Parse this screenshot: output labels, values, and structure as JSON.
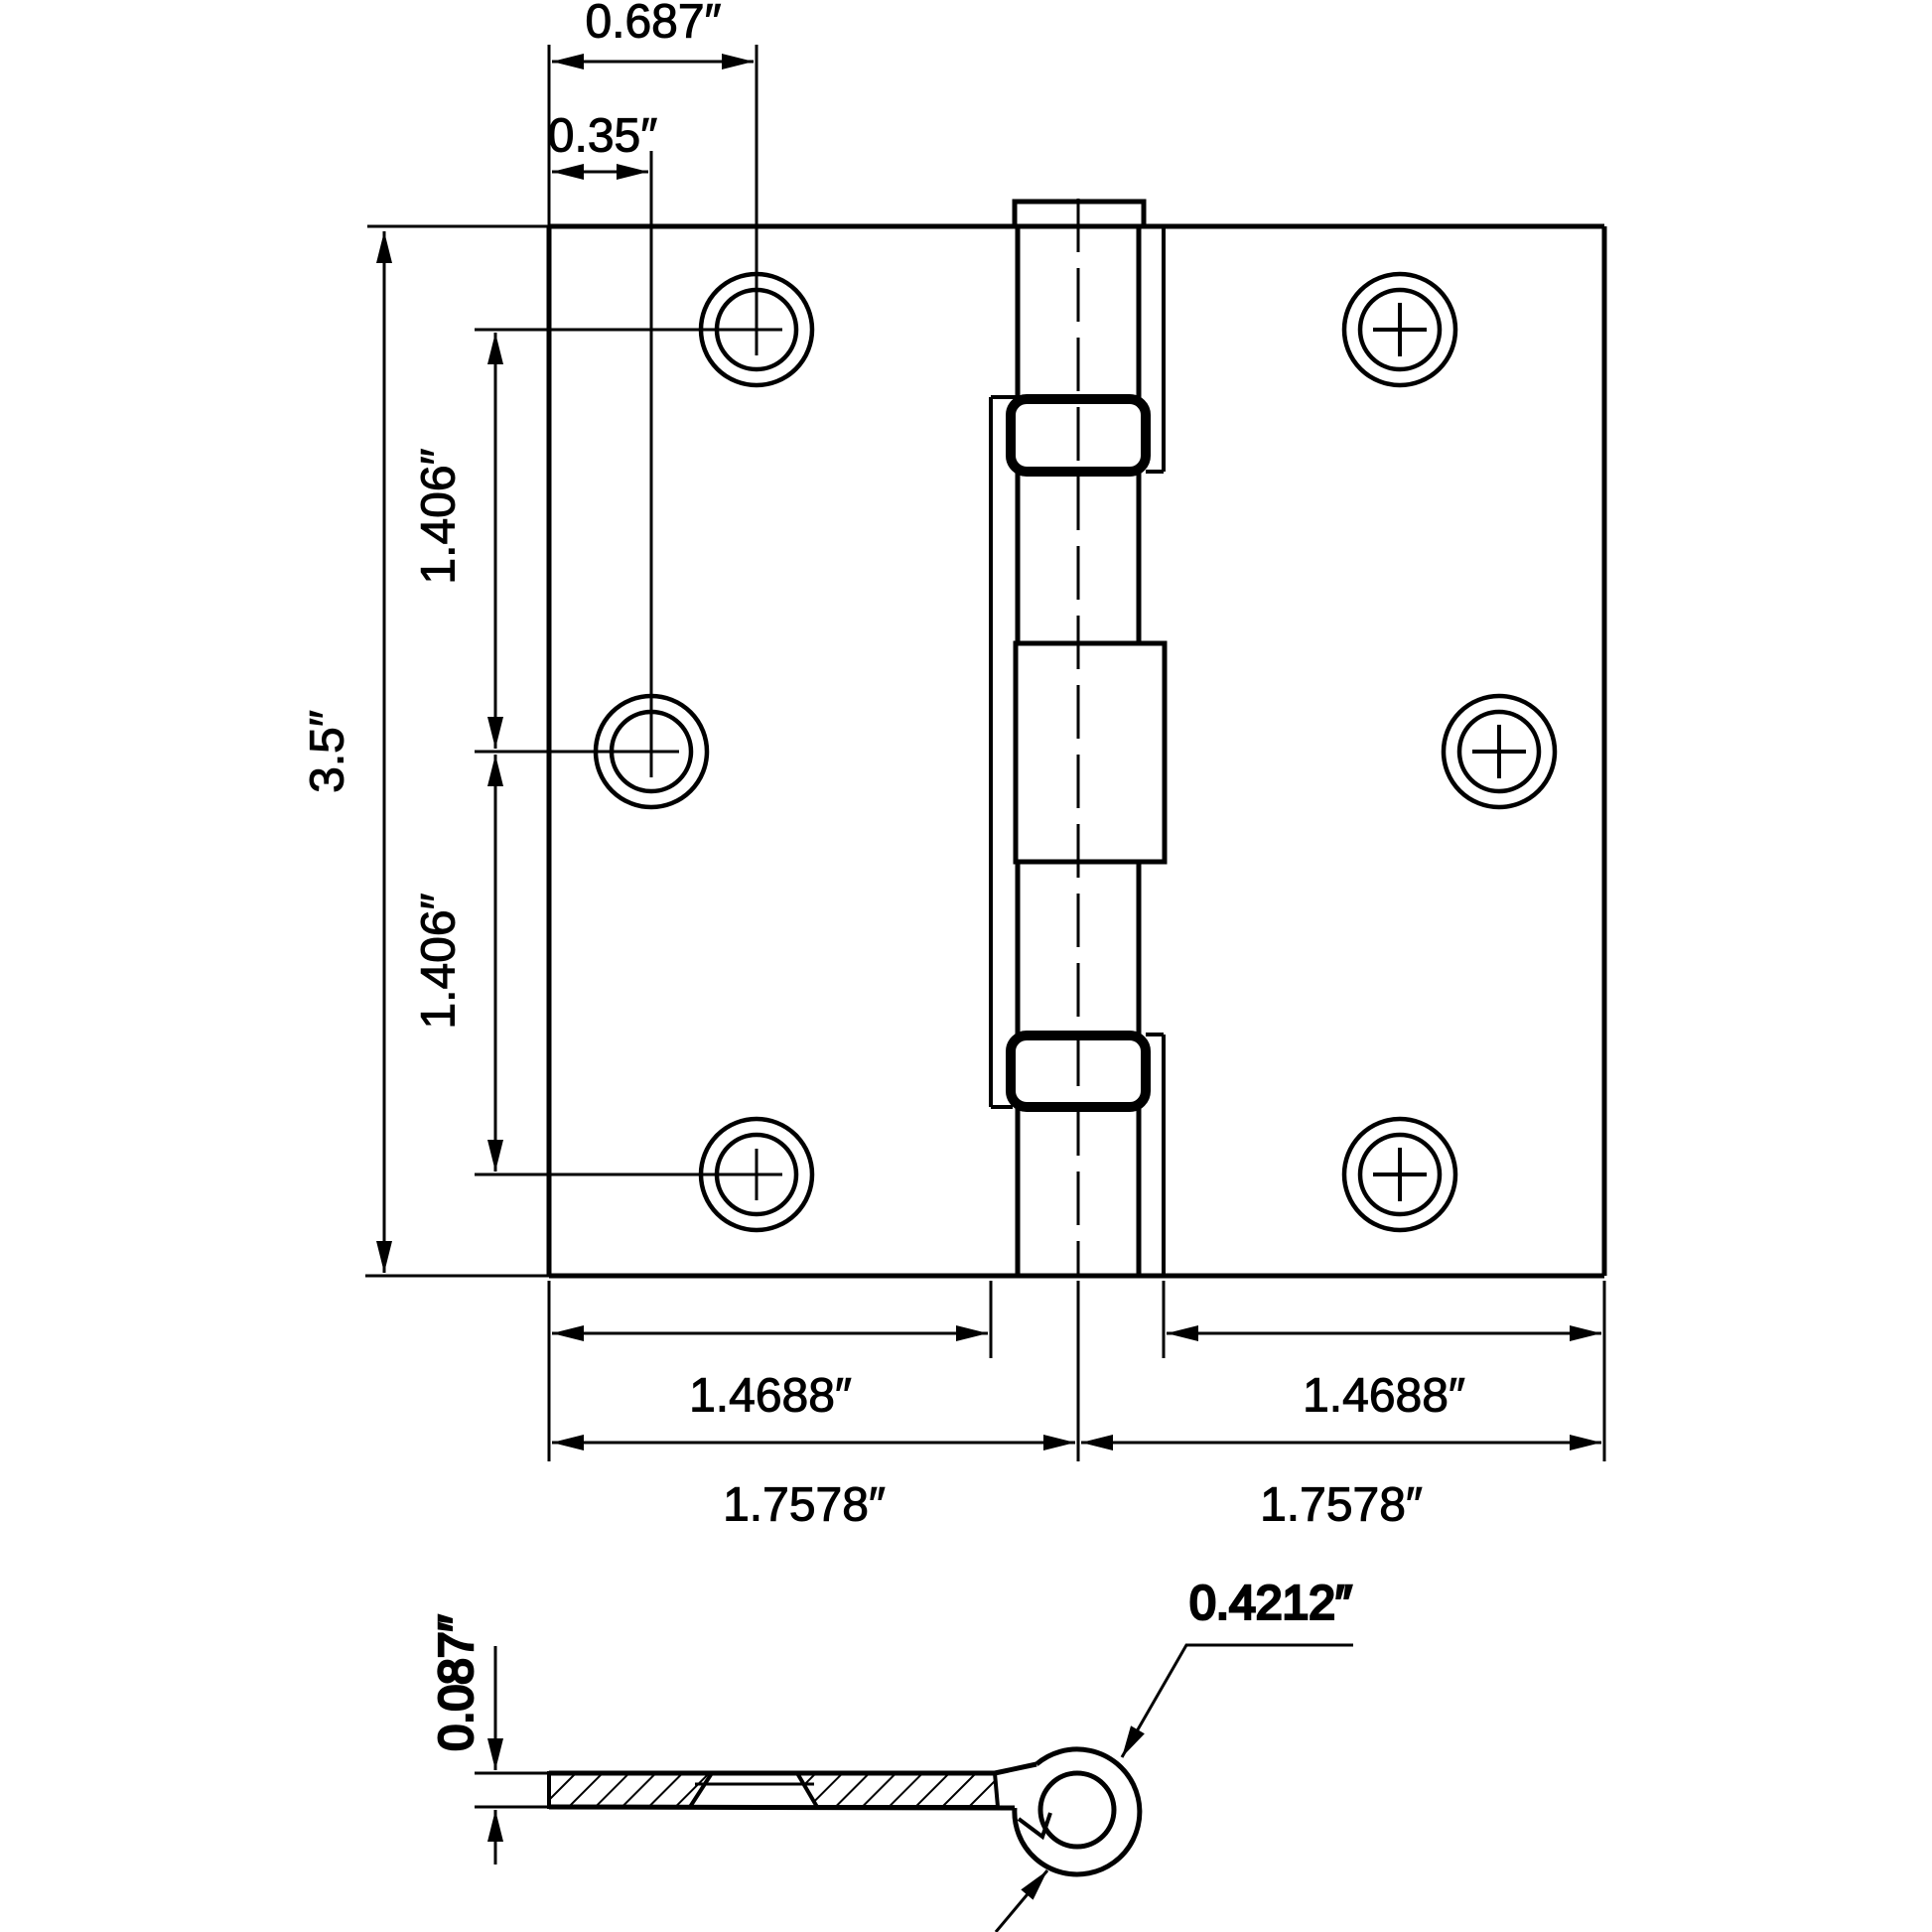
{
  "drawing": {
    "title": "butt-hinge-dimension-drawing",
    "colors": {
      "line": "#000000",
      "background": "#ffffff"
    },
    "front_view": {
      "dim_top_hole_offset": "0.687″",
      "dim_top_hole_offset_small": "0.35″",
      "dim_height": "3.5″",
      "dim_hole_spacing_upper": "1.406″",
      "dim_hole_spacing_lower": "1.406″",
      "dim_leaf_width_left": "1.4688″",
      "dim_leaf_width_right": "1.4688″",
      "dim_half_width_left": "1.7578″",
      "dim_half_width_right": "1.7578″"
    },
    "side_view": {
      "dim_thickness": "0.087″",
      "dim_knuckle_diameter": "0.4212″"
    }
  }
}
